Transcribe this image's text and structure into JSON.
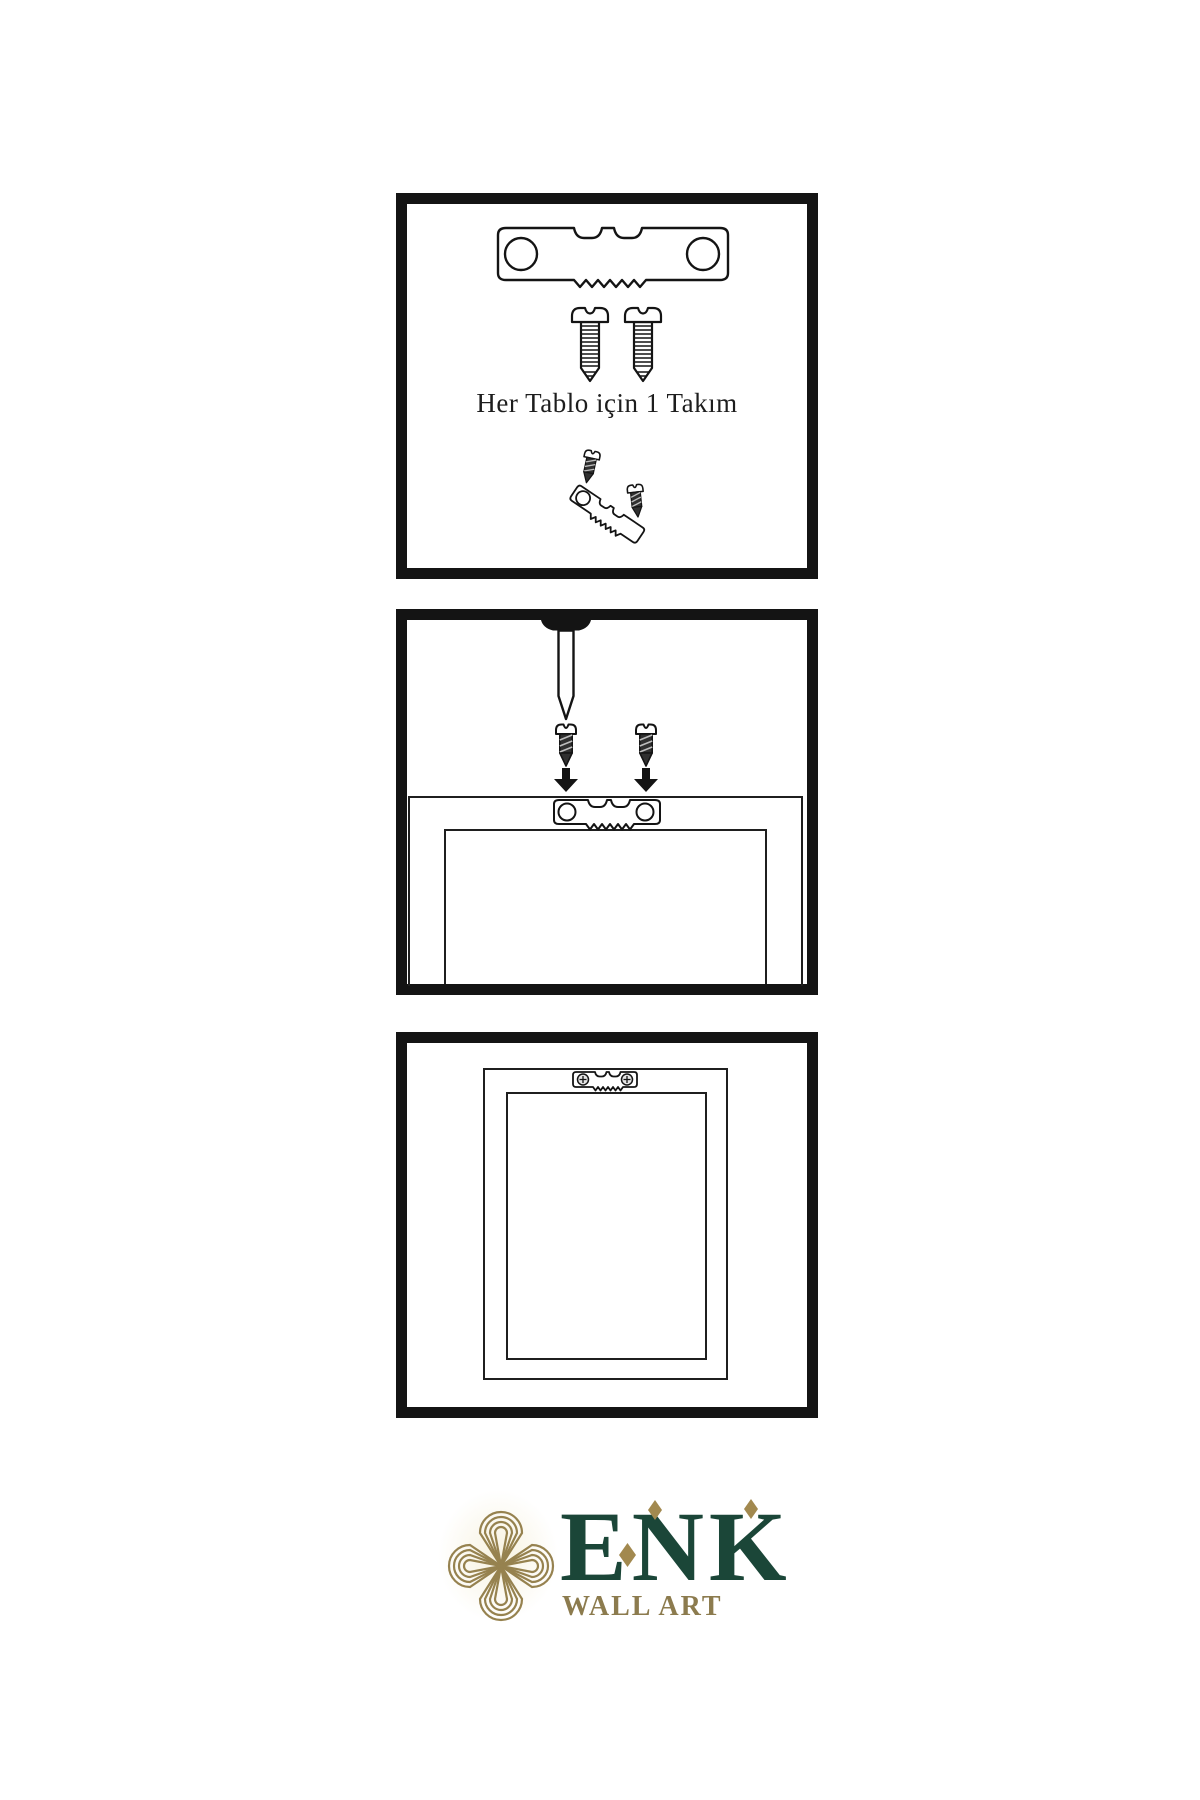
{
  "colors": {
    "paper": "#ffffff",
    "ink": "#141414",
    "line": "#1f1f1f",
    "screw_dark": "#303030",
    "stripe": "#bdbdbd",
    "green": "#1b4638",
    "gold": "#a2894f",
    "gold_dark": "#8c7b4e",
    "knot_gold": "#96824f"
  },
  "panels": [
    {
      "name": "hardware-kit-panel",
      "caption": "Her Tablo için 1 Takım",
      "icons": [
        "sawtooth-hanger-icon",
        "screw-icon",
        "screw-icon",
        "screw-into-tilted-hanger-icon"
      ]
    },
    {
      "name": "wall-nail-panel",
      "icons": [
        "nail-icon",
        "screw-icon",
        "down-arrow-icon",
        "screw-icon",
        "down-arrow-icon",
        "frame-top-with-sawtooth-hanger-icon"
      ]
    },
    {
      "name": "hanging-frame-panel",
      "icons": [
        "framed-picture-icon",
        "mounted-sawtooth-hanger-icon"
      ]
    }
  ],
  "brand": {
    "name": "ENK",
    "tagline": "WALL ART",
    "emblem": "interlaced-knot-icon"
  }
}
